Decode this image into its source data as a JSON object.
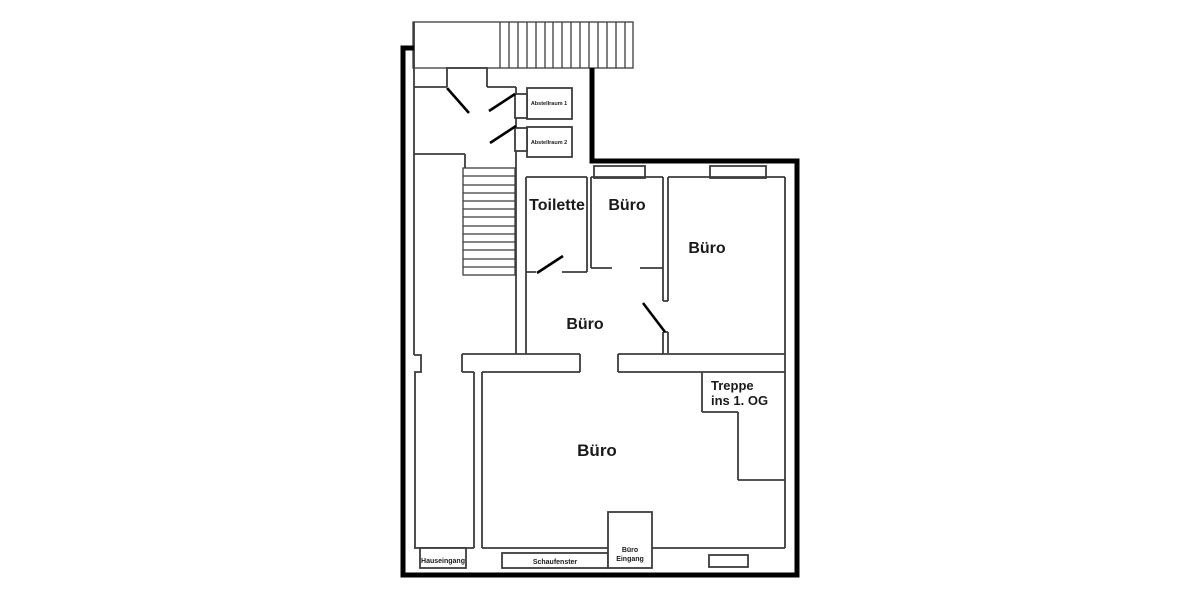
{
  "labels": {
    "toilette": "Toilette",
    "buero_small": "Büro",
    "buero_large": "Büro",
    "buero_middle": "Büro",
    "buero_main": "Büro",
    "abstellraum_1": "Abstellraum 1",
    "abstellraum_2": "Abstellraum 2",
    "treppe_line_1": "Treppe",
    "treppe_line_2": "ins 1. OG",
    "hauseingang": "Hauseingang",
    "schaufenster": "Schaufenster",
    "buero_eingang_line_1": "Büro",
    "buero_eingang_line_2": "Eingang"
  },
  "colors": {
    "background": "#ffffff",
    "outer_wall": "#000000",
    "inner_wall": "#3c3c3c",
    "text": "#1a1a1a"
  }
}
